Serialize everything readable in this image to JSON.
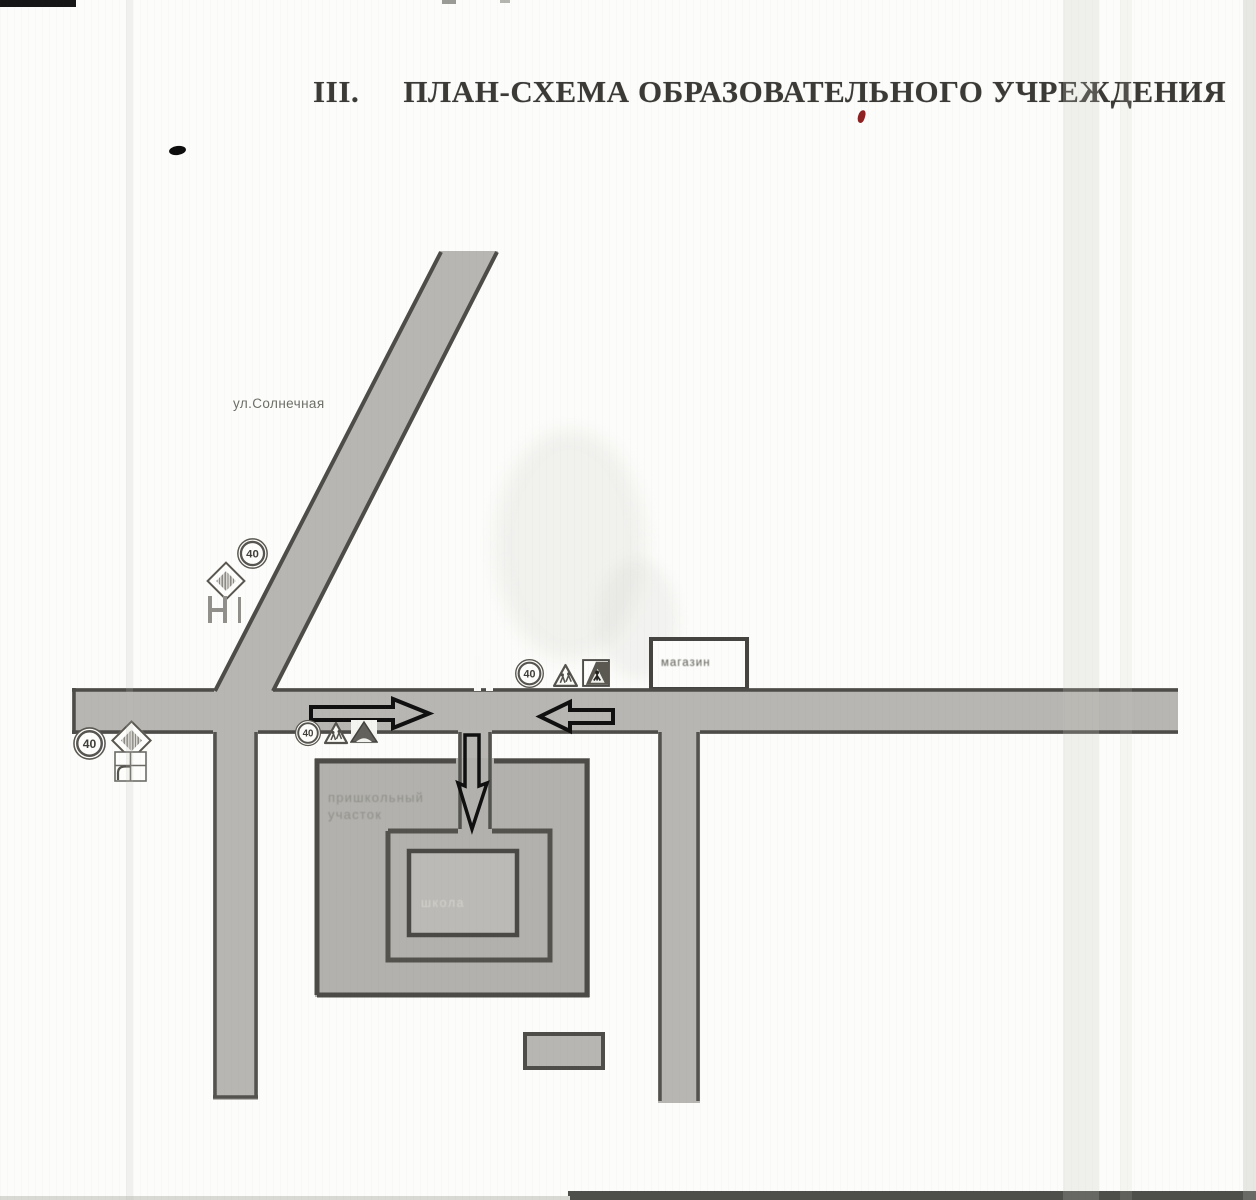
{
  "page": {
    "section_number": "III.",
    "title": "ПЛАН-СХЕМА ОБРАЗОВАТЕЛЬНОГО УЧРЕЖДЕНИЯ"
  },
  "map": {
    "street_label": "ул.Солнечная",
    "shop_label": "магазин",
    "school_label": "школа",
    "grounds_label": {
      "line1": "пришкольный",
      "line2": "участок"
    },
    "speed_limit_value": "40",
    "legend_semantics": {
      "speed_limit_sign": "speed limit 40 road sign",
      "diamond_sign": "pedestrian crossing diamond marker",
      "triangle_sign": "children warning triangle sign",
      "square_sign": "pedestrian crossing square sign",
      "arrows": "vehicle/pedestrian movement direction arrows"
    },
    "colors": {
      "paper": "#fcfcfa",
      "road_fill": "#b8b6b2",
      "road_border": "#4d4c48",
      "grounds_fill": "#b3b1ad",
      "school_fill": "#bcbab6",
      "building_fill": "#fcfcfa",
      "ink": "#3b3a37",
      "arrow_outline": "#101010",
      "red_mark": "#8e2222"
    }
  }
}
